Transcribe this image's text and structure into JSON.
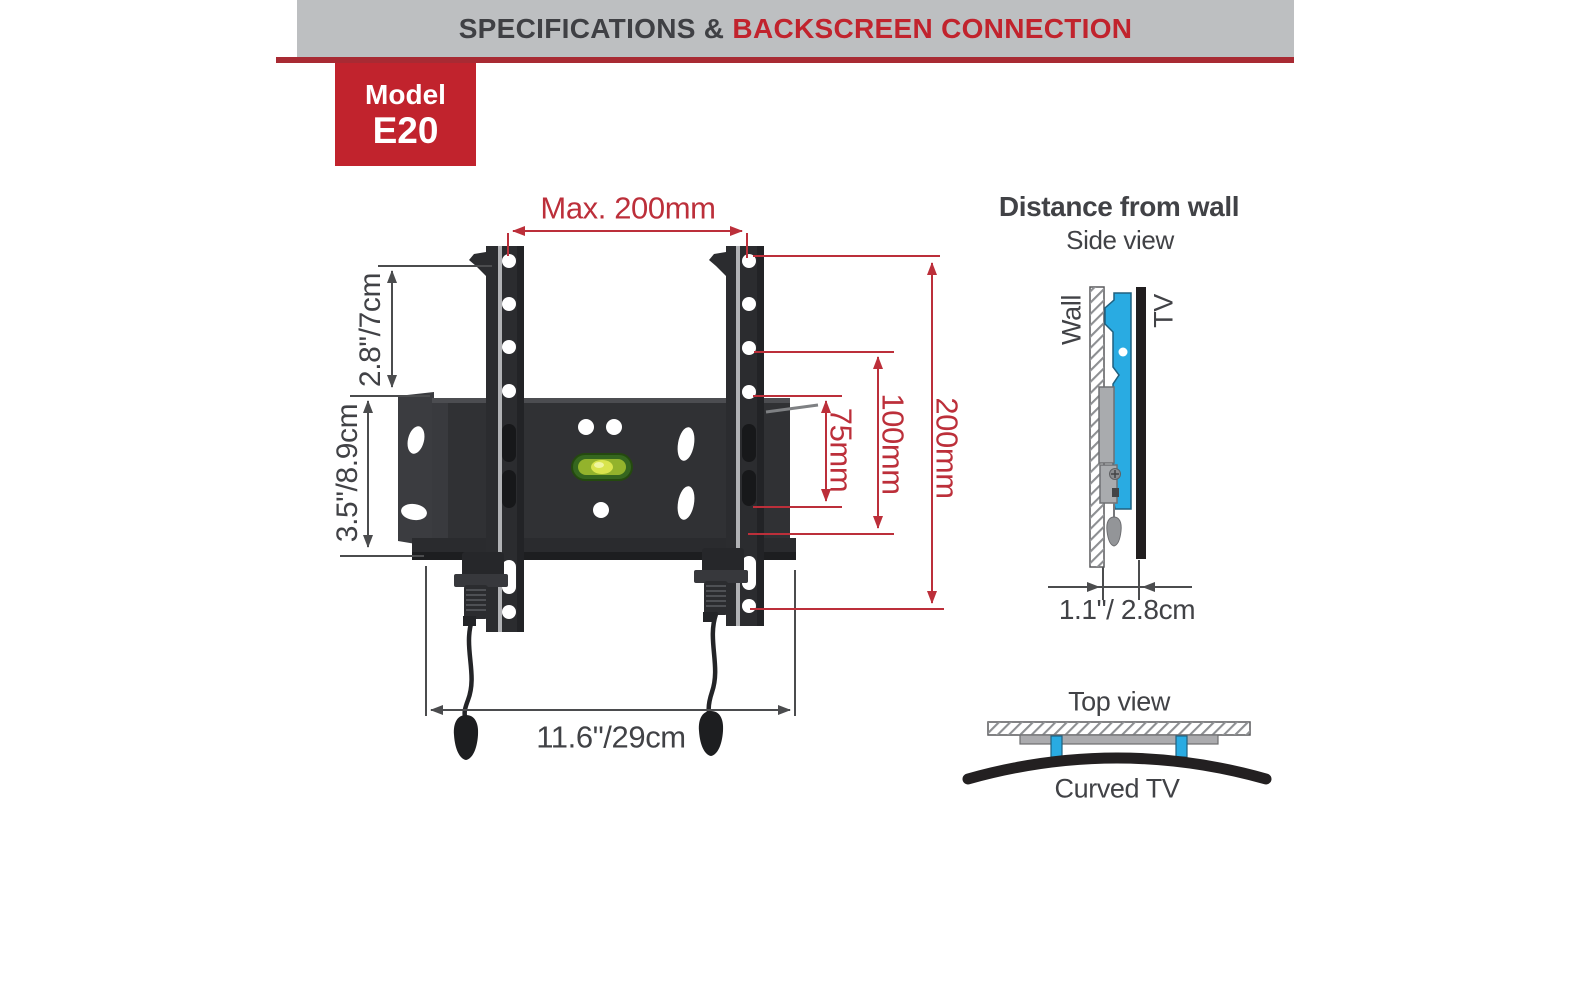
{
  "header": {
    "title_left": "SPECIFICATIONS &",
    "title_right": "BACKSCREEN CONNECTION"
  },
  "model_badge": {
    "label": "Model",
    "code": "E20"
  },
  "front_view": {
    "dim_top_width": "Max. 200mm",
    "dim_hook_height": "2.8\"/7cm",
    "dim_plate_height": "3.5\"/8.9cm",
    "dim_vesa_75": "75mm",
    "dim_vesa_100": "100mm",
    "dim_vesa_200": "200mm",
    "dim_total_width": "11.6\"/29cm"
  },
  "side_view": {
    "title": "Distance from wall",
    "subtitle": "Side view",
    "wall_label": "Wall",
    "tv_label": "TV",
    "dim_distance": "1.1\"/ 2.8cm"
  },
  "top_view": {
    "title": "Top view",
    "caption": "Curved TV"
  },
  "colors": {
    "accent_red": "#c1232d",
    "dim_red": "#bc2f3a",
    "text_dark": "#414246",
    "header_gray": "#bdbfc1",
    "bracket_blue": "#29abe2",
    "mount_dark": "#2b2c2f"
  }
}
